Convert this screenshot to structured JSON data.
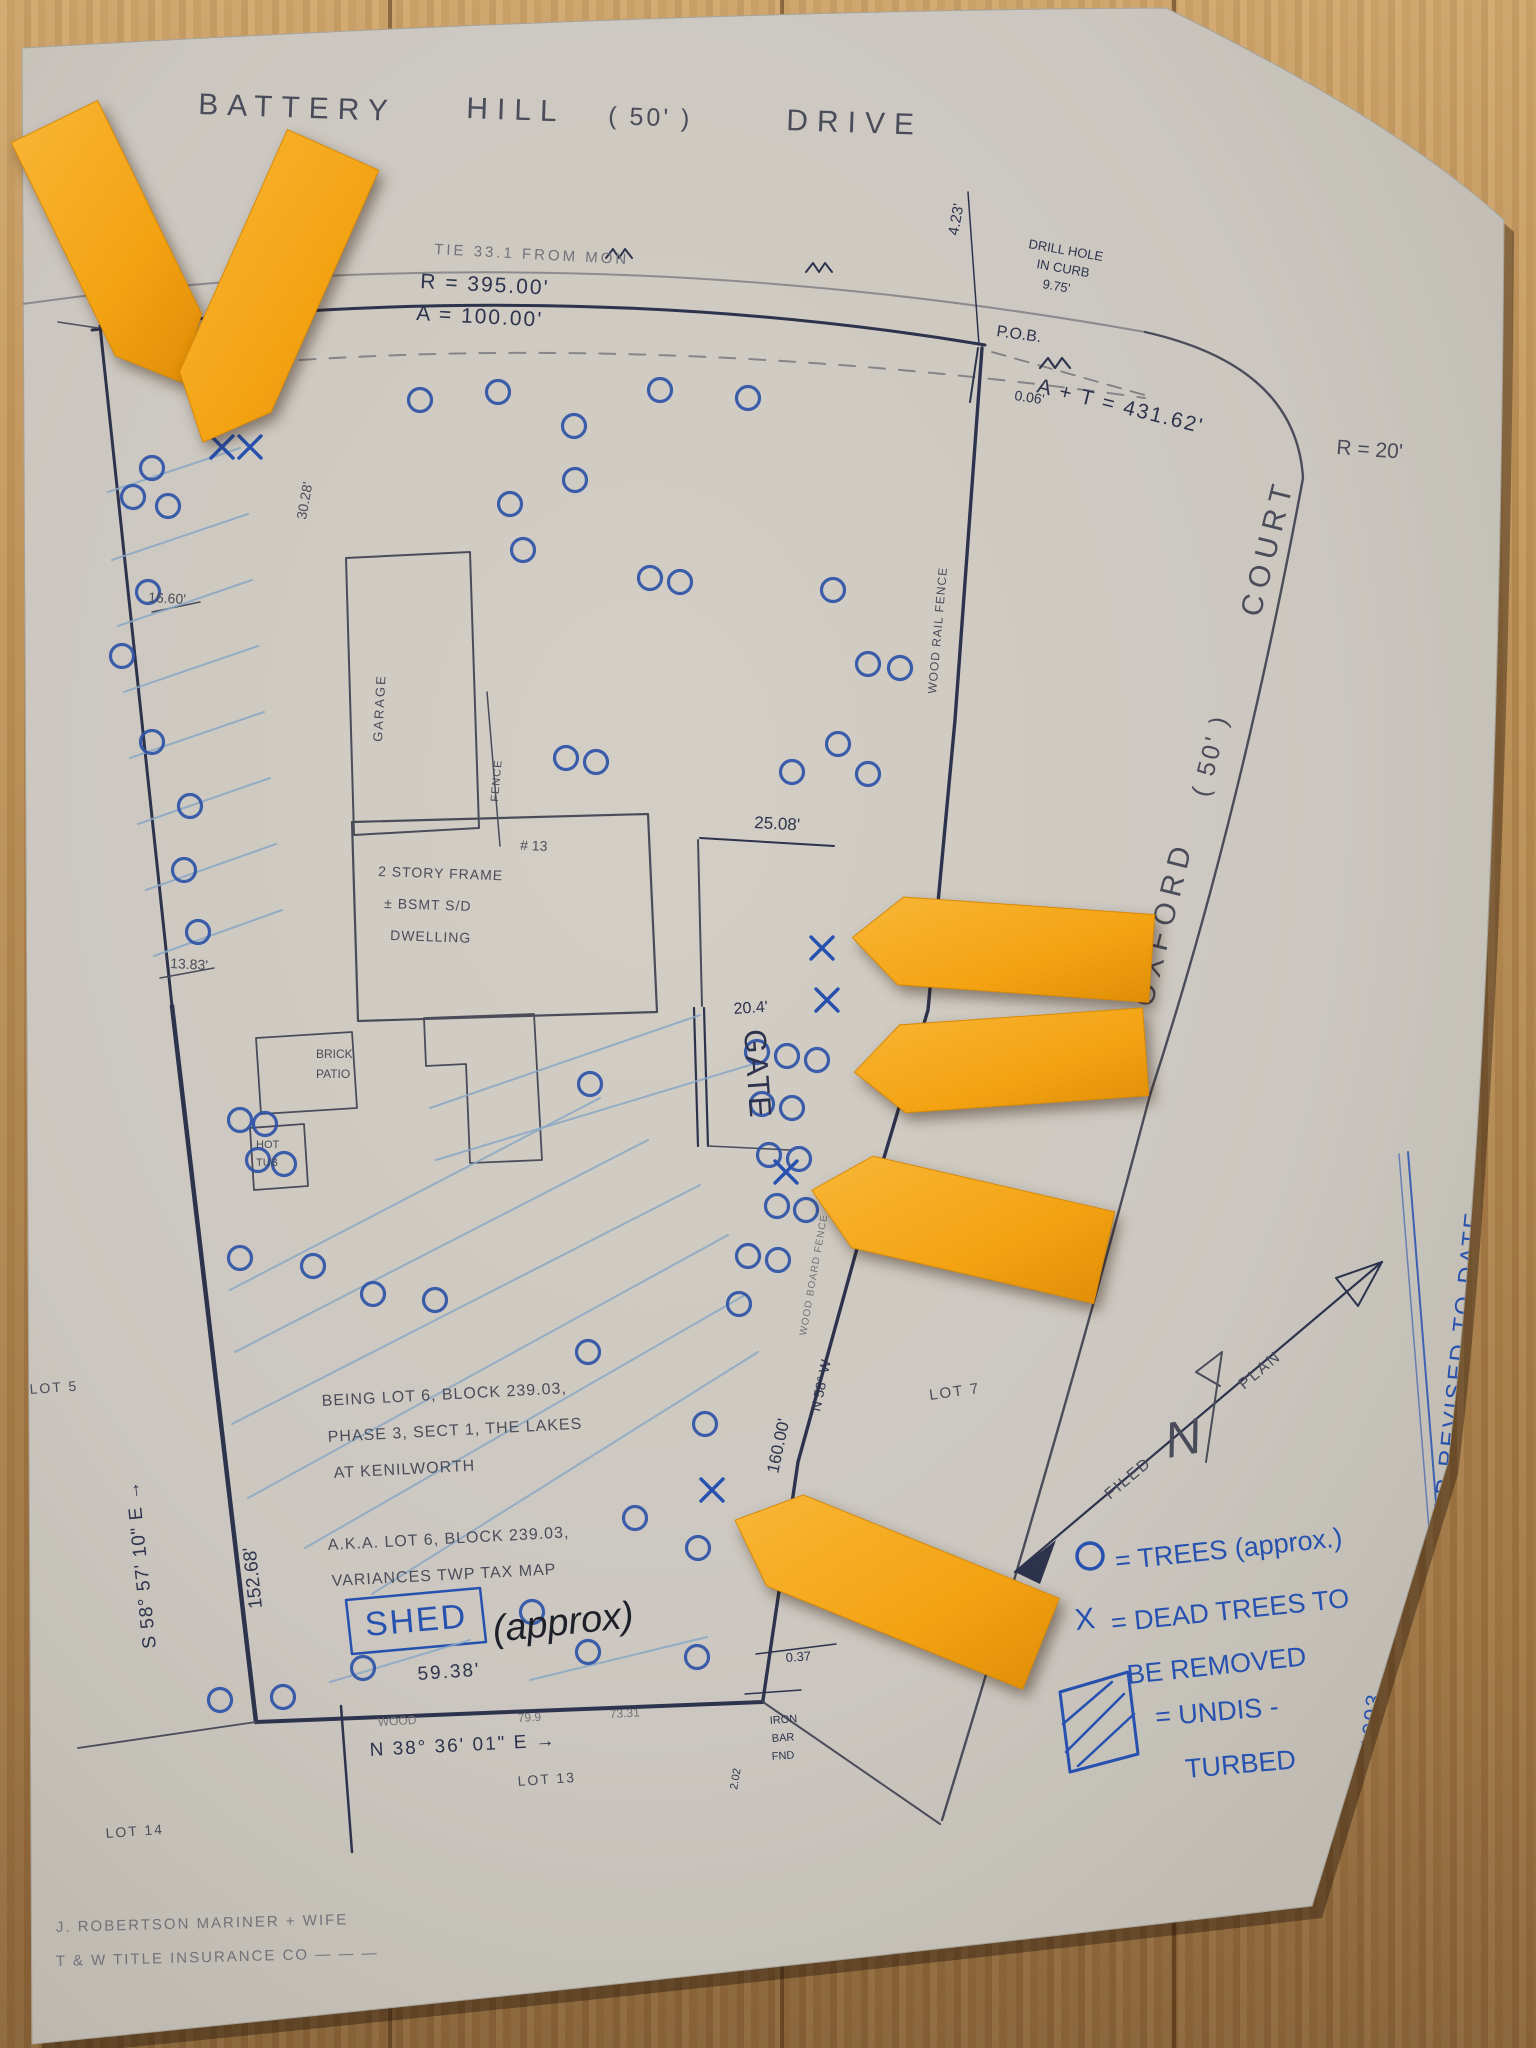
{
  "scene": "hand-drawn property survey plot plan on paper, photographed on a wood floor, with orange sticky arrows marking dead trees",
  "colors": {
    "wood": "#b2854f",
    "paper": "#d6d3cc",
    "pencil": "#4b4e5e",
    "ink": "#2c3350",
    "blue": "#2553b8",
    "tree": "#2d55b0",
    "hatch": "#8fafcf",
    "faint": "#74767f",
    "black": "#1c1f2a",
    "sticky": "#f5a51d",
    "sticky_edge": "#d88a08"
  },
  "legend": {
    "tree_symbol": "O",
    "tree_label": "= TREES (approx.)",
    "dead_symbol": "X",
    "dead_label": "= DEAD TREES TO BE REMOVED",
    "undisturbed_label": "= UNDIS-TURBED"
  },
  "labels": [
    {
      "n": "street-name-battery",
      "t": "BATTERY",
      "x": 198,
      "y": 114,
      "r": 2,
      "s": 30,
      "c": "pencil",
      "ls": 9
    },
    {
      "n": "street-name-hill",
      "t": "HILL",
      "x": 466,
      "y": 118,
      "r": 2,
      "s": 30,
      "c": "pencil",
      "ls": 9
    },
    {
      "n": "street-width-50",
      "t": "( 50' )",
      "x": 608,
      "y": 124,
      "r": 2,
      "s": 25,
      "c": "pencil",
      "ls": 3
    },
    {
      "n": "street-name-drive",
      "t": "DRIVE",
      "x": 786,
      "y": 130,
      "r": 2,
      "s": 30,
      "c": "pencil",
      "ls": 9
    },
    {
      "n": "tie-note",
      "t": "TIE 33.1 FROM MON",
      "x": 434,
      "y": 254,
      "r": 3,
      "s": 15,
      "c": "faint",
      "ls": 3
    },
    {
      "n": "radius-395",
      "t": "R = 395.00'",
      "x": 420,
      "y": 288,
      "r": 3,
      "s": 21,
      "c": "ink",
      "ls": 2
    },
    {
      "n": "arc-100",
      "t": "A = 100.00'",
      "x": 416,
      "y": 320,
      "r": 3,
      "s": 21,
      "c": "ink",
      "ls": 2
    },
    {
      "n": "offset-4-23",
      "t": "4.23'",
      "x": 958,
      "y": 236,
      "r": -80,
      "s": 15,
      "c": "ink"
    },
    {
      "n": "drill-hole-note-1",
      "t": "DRILL HOLE",
      "x": 1028,
      "y": 248,
      "r": 10,
      "s": 13,
      "c": "ink"
    },
    {
      "n": "drill-hole-note-2",
      "t": "IN CURB",
      "x": 1036,
      "y": 268,
      "r": 10,
      "s": 13,
      "c": "ink"
    },
    {
      "n": "drill-hole-note-3",
      "t": "9.75'",
      "x": 1042,
      "y": 288,
      "r": 10,
      "s": 13,
      "c": "ink"
    },
    {
      "n": "pob-label",
      "t": "P.O.B.",
      "x": 996,
      "y": 336,
      "r": 8,
      "s": 16,
      "c": "ink"
    },
    {
      "n": "offset-0-06",
      "t": "0.06'",
      "x": 1014,
      "y": 400,
      "r": 8,
      "s": 14,
      "c": "ink"
    },
    {
      "n": "arc-tangent-431",
      "t": "A + T = 431.62'",
      "x": 1036,
      "y": 392,
      "r": 14,
      "s": 21,
      "c": "ink",
      "ls": 2
    },
    {
      "n": "radius-20",
      "t": "R = 20'",
      "x": 1336,
      "y": 454,
      "r": 4,
      "s": 21,
      "c": "pencil"
    },
    {
      "n": "street-oxford",
      "t": "OXFORD",
      "x": 1152,
      "y": 1008,
      "r": -76,
      "s": 30,
      "c": "pencil",
      "ls": 7
    },
    {
      "n": "street-oxford-width",
      "t": "( 50' )",
      "x": 1208,
      "y": 798,
      "r": -76,
      "s": 25,
      "c": "pencil",
      "ls": 3
    },
    {
      "n": "street-oxford-court",
      "t": "COURT",
      "x": 1260,
      "y": 618,
      "r": -76,
      "s": 30,
      "c": "pencil",
      "ls": 7
    },
    {
      "n": "wood-rail-fence-note",
      "t": "WOOD RAIL FENCE",
      "x": 936,
      "y": 694,
      "r": -85,
      "s": 12,
      "c": "pencil",
      "ls": 1
    },
    {
      "n": "dim-25-08",
      "t": "25.08'",
      "x": 754,
      "y": 828,
      "r": 3,
      "s": 17,
      "c": "ink"
    },
    {
      "n": "gate-label",
      "t": "GATE",
      "x": 744,
      "y": 1030,
      "r": 86,
      "s": 31,
      "c": "ink",
      "ls": 2
    },
    {
      "n": "dim-20-4",
      "t": "20.4'",
      "x": 734,
      "y": 1014,
      "r": -4,
      "s": 16,
      "c": "ink"
    },
    {
      "n": "house-number",
      "t": "# 13",
      "x": 520,
      "y": 850,
      "r": 2,
      "s": 14,
      "c": "pencil"
    },
    {
      "n": "dwelling-note-1",
      "t": "2 STORY FRAME",
      "x": 378,
      "y": 876,
      "r": 2,
      "s": 14,
      "c": "pencil",
      "ls": 1
    },
    {
      "n": "dwelling-note-2",
      "t": "± BSMT S/D",
      "x": 384,
      "y": 908,
      "r": 2,
      "s": 14,
      "c": "pencil",
      "ls": 1
    },
    {
      "n": "dwelling-note-3",
      "t": "DWELLING",
      "x": 390,
      "y": 940,
      "r": 2,
      "s": 14,
      "c": "pencil",
      "ls": 1
    },
    {
      "n": "garage-label",
      "t": "GARAGE",
      "x": 382,
      "y": 742,
      "r": -87,
      "s": 13,
      "c": "pencil",
      "ls": 2
    },
    {
      "n": "fence-label",
      "t": "FENCE",
      "x": 498,
      "y": 802,
      "r": -85,
      "s": 11,
      "c": "pencil",
      "ls": 1
    },
    {
      "n": "brick-patio-1",
      "t": "BRICK",
      "x": 316,
      "y": 1058,
      "r": 0,
      "s": 12,
      "c": "pencil"
    },
    {
      "n": "brick-patio-2",
      "t": "PATIO",
      "x": 316,
      "y": 1078,
      "r": 0,
      "s": 12,
      "c": "pencil"
    },
    {
      "n": "hot-tub-1",
      "t": "HOT",
      "x": 256,
      "y": 1148,
      "r": 0,
      "s": 11,
      "c": "pencil"
    },
    {
      "n": "hot-tub-2",
      "t": "TUB",
      "x": 256,
      "y": 1166,
      "r": 0,
      "s": 11,
      "c": "pencil"
    },
    {
      "n": "dim-16-60",
      "t": "16.60'",
      "x": 148,
      "y": 602,
      "r": 3,
      "s": 14,
      "c": "pencil"
    },
    {
      "n": "dim-13-83",
      "t": "13.83'",
      "x": 170,
      "y": 968,
      "r": 3,
      "s": 14,
      "c": "pencil"
    },
    {
      "n": "dim-30-28",
      "t": "30.28'",
      "x": 306,
      "y": 520,
      "r": -80,
      "s": 14,
      "c": "pencil"
    },
    {
      "n": "being-note-1",
      "t": "BEING LOT 6, BLOCK 239.03,",
      "x": 322,
      "y": 1406,
      "r": -3,
      "s": 16,
      "c": "pencil",
      "ls": 1
    },
    {
      "n": "being-note-2",
      "t": "PHASE 3, SECT 1, THE LAKES",
      "x": 328,
      "y": 1442,
      "r": -3,
      "s": 16,
      "c": "pencil",
      "ls": 1
    },
    {
      "n": "being-note-3",
      "t": "AT KENILWORTH",
      "x": 334,
      "y": 1478,
      "r": -3,
      "s": 16,
      "c": "pencil",
      "ls": 1
    },
    {
      "n": "aka-note-1",
      "t": "A.K.A. LOT 6, BLOCK 239.03,",
      "x": 328,
      "y": 1550,
      "r": -3,
      "s": 16,
      "c": "pencil",
      "ls": 1
    },
    {
      "n": "aka-note-2",
      "t": "VARIANCES TWP TAX MAP",
      "x": 332,
      "y": 1586,
      "r": -3,
      "s": 16,
      "c": "pencil",
      "ls": 1
    },
    {
      "n": "lot-5-label",
      "t": "LOT 5",
      "x": 30,
      "y": 1394,
      "r": -4,
      "s": 14,
      "c": "pencil",
      "ls": 2
    },
    {
      "n": "lot-7-label",
      "t": "LOT 7",
      "x": 930,
      "y": 1400,
      "r": -8,
      "s": 15,
      "c": "pencil",
      "ls": 2
    },
    {
      "n": "lot-14-label",
      "t": "LOT 14",
      "x": 106,
      "y": 1838,
      "r": -4,
      "s": 14,
      "c": "pencil",
      "ls": 2
    },
    {
      "n": "lot-13-label",
      "t": "LOT 13",
      "x": 518,
      "y": 1786,
      "r": -4,
      "s": 14,
      "c": "pencil",
      "ls": 2
    },
    {
      "n": "bearing-left",
      "t": "S 58° 57' 10\" E →",
      "x": 156,
      "y": 1648,
      "r": -96,
      "s": 19,
      "c": "ink",
      "ls": 1
    },
    {
      "n": "dim-152-68",
      "t": "152.68'",
      "x": 262,
      "y": 1608,
      "r": -96,
      "s": 19,
      "c": "ink"
    },
    {
      "n": "shed-label",
      "t": "SHED",
      "x": 366,
      "y": 1636,
      "r": -5,
      "s": 34,
      "c": "blue",
      "ls": 2
    },
    {
      "n": "shed-approx",
      "t": "(approx)",
      "x": 494,
      "y": 1642,
      "r": -6,
      "s": 38,
      "c": "black",
      "i": 1
    },
    {
      "n": "dim-59-38",
      "t": "59.38'",
      "x": 418,
      "y": 1680,
      "r": -4,
      "s": 19,
      "c": "ink",
      "ls": 2
    },
    {
      "n": "fence-note-bottom",
      "t": "WOOD",
      "x": 378,
      "y": 1726,
      "r": -3,
      "s": 12,
      "c": "faint"
    },
    {
      "n": "dim-79-9",
      "t": "79.9",
      "x": 518,
      "y": 1722,
      "r": -3,
      "s": 12,
      "c": "faint"
    },
    {
      "n": "dim-73-31",
      "t": "73.31",
      "x": 610,
      "y": 1718,
      "r": -3,
      "s": 12,
      "c": "faint"
    },
    {
      "n": "bearing-bottom",
      "t": "N 38° 36' 01\" E →",
      "x": 370,
      "y": 1756,
      "r": -3,
      "s": 19,
      "c": "ink",
      "ls": 2
    },
    {
      "n": "dim-0-37",
      "t": "0.37",
      "x": 786,
      "y": 1662,
      "r": -4,
      "s": 13,
      "c": "ink"
    },
    {
      "n": "iron-bar-1",
      "t": "IRON",
      "x": 770,
      "y": 1724,
      "r": -4,
      "s": 11,
      "c": "ink"
    },
    {
      "n": "iron-bar-2",
      "t": "BAR",
      "x": 772,
      "y": 1742,
      "r": -4,
      "s": 11,
      "c": "ink"
    },
    {
      "n": "iron-bar-3",
      "t": "FND",
      "x": 772,
      "y": 1760,
      "r": -4,
      "s": 11,
      "c": "ink"
    },
    {
      "n": "dim-2-02",
      "t": "2.02",
      "x": 737,
      "y": 1790,
      "r": -80,
      "s": 11,
      "c": "ink"
    },
    {
      "n": "dim-160-00",
      "t": "160.00'",
      "x": 778,
      "y": 1474,
      "r": -78,
      "s": 17,
      "c": "ink"
    },
    {
      "n": "bearing-fence",
      "t": "N 58° W",
      "x": 820,
      "y": 1412,
      "r": -78,
      "s": 14,
      "c": "ink"
    },
    {
      "n": "fence-note-right",
      "t": "WOOD BOARD FENCE",
      "x": 806,
      "y": 1336,
      "r": -80,
      "s": 10,
      "c": "faint",
      "ls": 1
    },
    {
      "n": "filed-label",
      "t": "FILED",
      "x": 1110,
      "y": 1500,
      "r": -40,
      "s": 16,
      "c": "pencil",
      "ls": 2
    },
    {
      "n": "plan-label",
      "t": "PLAN",
      "x": 1244,
      "y": 1390,
      "r": -40,
      "s": 16,
      "c": "pencil",
      "ls": 2
    },
    {
      "n": "north-letter",
      "t": "N",
      "x": 1168,
      "y": 1458,
      "r": -10,
      "s": 50,
      "c": "pencil",
      "i": 1
    },
    {
      "n": "legend-trees-label",
      "t": "= TREES (approx.)",
      "x": 1116,
      "y": 1570,
      "r": -6,
      "s": 27,
      "c": "blue"
    },
    {
      "n": "legend-dead-symbol",
      "t": "X",
      "x": 1076,
      "y": 1630,
      "r": -6,
      "s": 30,
      "c": "blue"
    },
    {
      "n": "legend-dead-label-1",
      "t": "= DEAD TREES TO",
      "x": 1112,
      "y": 1632,
      "r": -6,
      "s": 27,
      "c": "blue"
    },
    {
      "n": "legend-dead-label-2",
      "t": "BE REMOVED",
      "x": 1128,
      "y": 1684,
      "r": -6,
      "s": 27,
      "c": "blue"
    },
    {
      "n": "legend-undisturbed-1",
      "t": "= UNDIS -",
      "x": 1156,
      "y": 1726,
      "r": -5,
      "s": 27,
      "c": "blue"
    },
    {
      "n": "legend-undisturbed-2",
      "t": "TURBED",
      "x": 1186,
      "y": 1778,
      "r": -5,
      "s": 27,
      "c": "blue"
    },
    {
      "n": "margin-revision-note",
      "t": "JUNE 26, 1959  RESURVEYED — MAP REVISED TO DATE",
      "x": 1400,
      "y": 1988,
      "r": -84,
      "s": 24,
      "c": "blue",
      "ls": 3
    },
    {
      "n": "margin-date-1993",
      "t": "JULY 30, 1993",
      "x": 1364,
      "y": 1862,
      "r": -84,
      "s": 22,
      "c": "blue",
      "ls": 2
    },
    {
      "n": "surveyor-note-1",
      "t": "J. ROBERTSON MARINER + WIFE",
      "x": 56,
      "y": 1932,
      "r": -1.5,
      "s": 15,
      "c": "faint",
      "ls": 2
    },
    {
      "n": "surveyor-note-2",
      "t": "T & W TITLE INSURANCE CO — — —",
      "x": 56,
      "y": 1966,
      "r": -1.5,
      "s": 15,
      "c": "faint",
      "ls": 2
    }
  ],
  "trees": [
    [
      152,
      468
    ],
    [
      133,
      497
    ],
    [
      168,
      506
    ],
    [
      148,
      592
    ],
    [
      122,
      656
    ],
    [
      152,
      742
    ],
    [
      190,
      806
    ],
    [
      184,
      870
    ],
    [
      198,
      932
    ],
    [
      420,
      400
    ],
    [
      498,
      392
    ],
    [
      574,
      426
    ],
    [
      660,
      390
    ],
    [
      748,
      398
    ],
    [
      510,
      504
    ],
    [
      575,
      480
    ],
    [
      523,
      550
    ],
    [
      650,
      578
    ],
    [
      680,
      582
    ],
    [
      566,
      758
    ],
    [
      596,
      762
    ],
    [
      833,
      590
    ],
    [
      868,
      664
    ],
    [
      900,
      668
    ],
    [
      838,
      744
    ],
    [
      792,
      772
    ],
    [
      868,
      774
    ],
    [
      590,
      1084
    ],
    [
      757,
      1052
    ],
    [
      787,
      1056
    ],
    [
      817,
      1060
    ],
    [
      762,
      1104
    ],
    [
      792,
      1108
    ],
    [
      769,
      1155
    ],
    [
      799,
      1159
    ],
    [
      777,
      1206
    ],
    [
      806,
      1210
    ],
    [
      748,
      1256
    ],
    [
      778,
      1260
    ],
    [
      739,
      1304
    ],
    [
      240,
      1120
    ],
    [
      265,
      1124
    ],
    [
      258,
      1160
    ],
    [
      284,
      1164
    ],
    [
      240,
      1258
    ],
    [
      313,
      1266
    ],
    [
      373,
      1294
    ],
    [
      435,
      1300
    ],
    [
      588,
      1352
    ],
    [
      705,
      1424
    ],
    [
      635,
      1518
    ],
    [
      698,
      1548
    ],
    [
      363,
      1668
    ],
    [
      588,
      1652
    ],
    [
      697,
      1657
    ],
    [
      532,
      1612
    ],
    [
      220,
      1700
    ],
    [
      283,
      1697
    ]
  ],
  "dead_trees": [
    [
      222,
      447
    ],
    [
      250,
      447
    ],
    [
      822,
      948
    ],
    [
      827,
      1000
    ],
    [
      786,
      1172
    ],
    [
      712,
      1490
    ]
  ],
  "hatch_lines": [
    [
      108,
      492,
      240,
      448
    ],
    [
      112,
      560,
      248,
      514
    ],
    [
      118,
      626,
      252,
      580
    ],
    [
      124,
      692,
      258,
      646
    ],
    [
      130,
      758,
      264,
      712
    ],
    [
      138,
      824,
      270,
      778
    ],
    [
      146,
      890,
      276,
      844
    ],
    [
      154,
      956,
      282,
      910
    ],
    [
      230,
      1290,
      600,
      1098
    ],
    [
      235,
      1352,
      648,
      1140
    ],
    [
      232,
      1424,
      700,
      1185
    ],
    [
      248,
      1498,
      728,
      1235
    ],
    [
      305,
      1548,
      745,
      1295
    ],
    [
      372,
      1594,
      758,
      1352
    ],
    [
      430,
      1108,
      700,
      1015
    ],
    [
      436,
      1160,
      760,
      1062
    ],
    [
      330,
      1682,
      470,
      1640
    ],
    [
      530,
      1680,
      707,
      1637
    ]
  ],
  "sticky_arrows": [
    {
      "name": "sticky-arrow-1",
      "cx": 118,
      "cy": 252,
      "len": 290,
      "wid": 96,
      "dir": 64
    },
    {
      "name": "sticky-arrow-2",
      "cx": 268,
      "cy": 296,
      "len": 320,
      "wid": 100,
      "dir": 114
    },
    {
      "name": "sticky-arrow-3",
      "cx": 1002,
      "cy": 948,
      "len": 300,
      "wid": 88,
      "dir": 184
    },
    {
      "name": "sticky-arrow-4",
      "cx": 1000,
      "cy": 1062,
      "len": 292,
      "wid": 88,
      "dir": 176
    },
    {
      "name": "sticky-arrow-5",
      "cx": 958,
      "cy": 1224,
      "len": 300,
      "wid": 94,
      "dir": 193
    },
    {
      "name": "sticky-arrow-6",
      "cx": 888,
      "cy": 1582,
      "len": 330,
      "wid": 98,
      "dir": 202
    }
  ]
}
